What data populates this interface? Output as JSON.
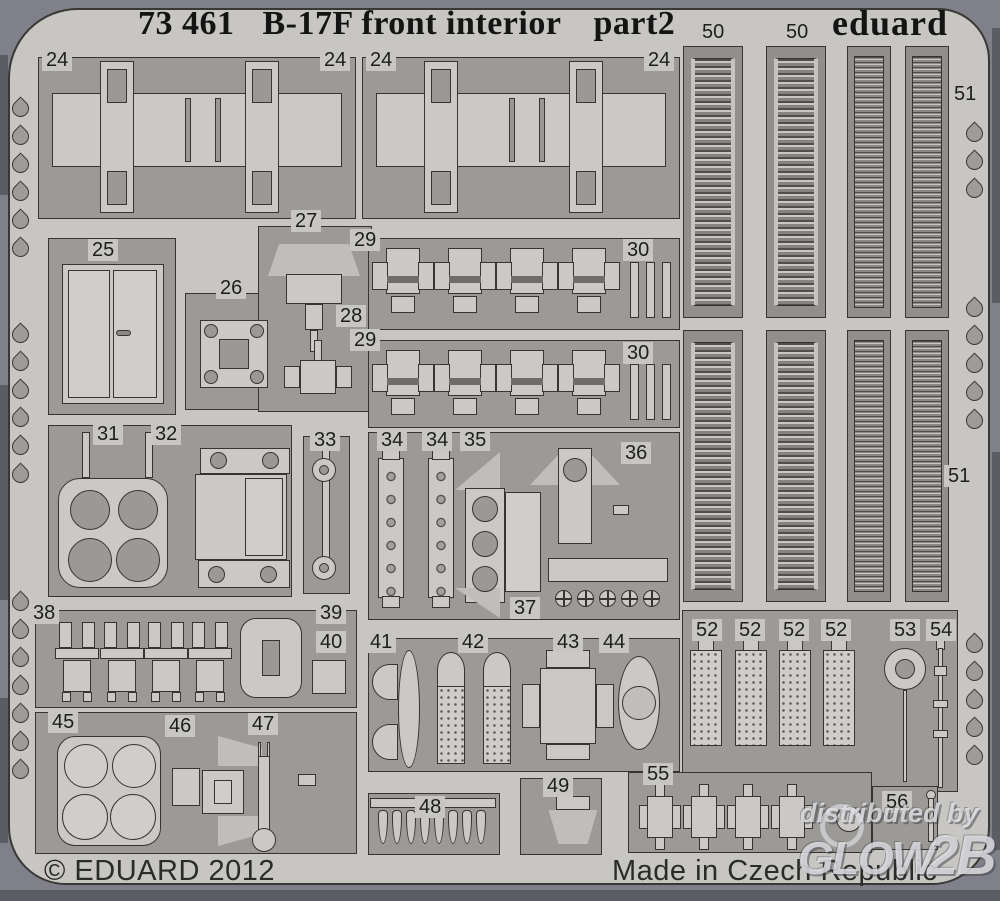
{
  "header": {
    "catalog_number": "73 461",
    "title": "B-17F front interior",
    "sheet_name": "part2",
    "brand_logo": "eduard"
  },
  "footer": {
    "copyright": "© EDUARD 2012",
    "made_in": "Made in Czech Republic"
  },
  "watermark": {
    "line1": "distributed by",
    "brand_part1": "GLOW",
    "brand_part2": "2B"
  },
  "colors": {
    "sheet_metal": "#c8c6c2",
    "etched_region": "#9c9a96",
    "scan_background": "#80808a",
    "outline": "#37352f"
  },
  "part_numbers": {
    "24": "24",
    "25": "25",
    "26": "26",
    "27": "27",
    "28": "28",
    "29": "29",
    "30": "30",
    "31": "31",
    "32": "32",
    "33": "33",
    "34": "34",
    "35": "35",
    "36": "36",
    "37": "37",
    "38": "38",
    "39": "39",
    "40": "40",
    "41": "41",
    "42": "42",
    "43": "43",
    "44": "44",
    "45": "45",
    "46": "46",
    "47": "47",
    "48": "48",
    "49": "49",
    "50": "50",
    "51": "51",
    "52": "52",
    "53": "53",
    "54": "54",
    "55": "55",
    "56": "56"
  }
}
